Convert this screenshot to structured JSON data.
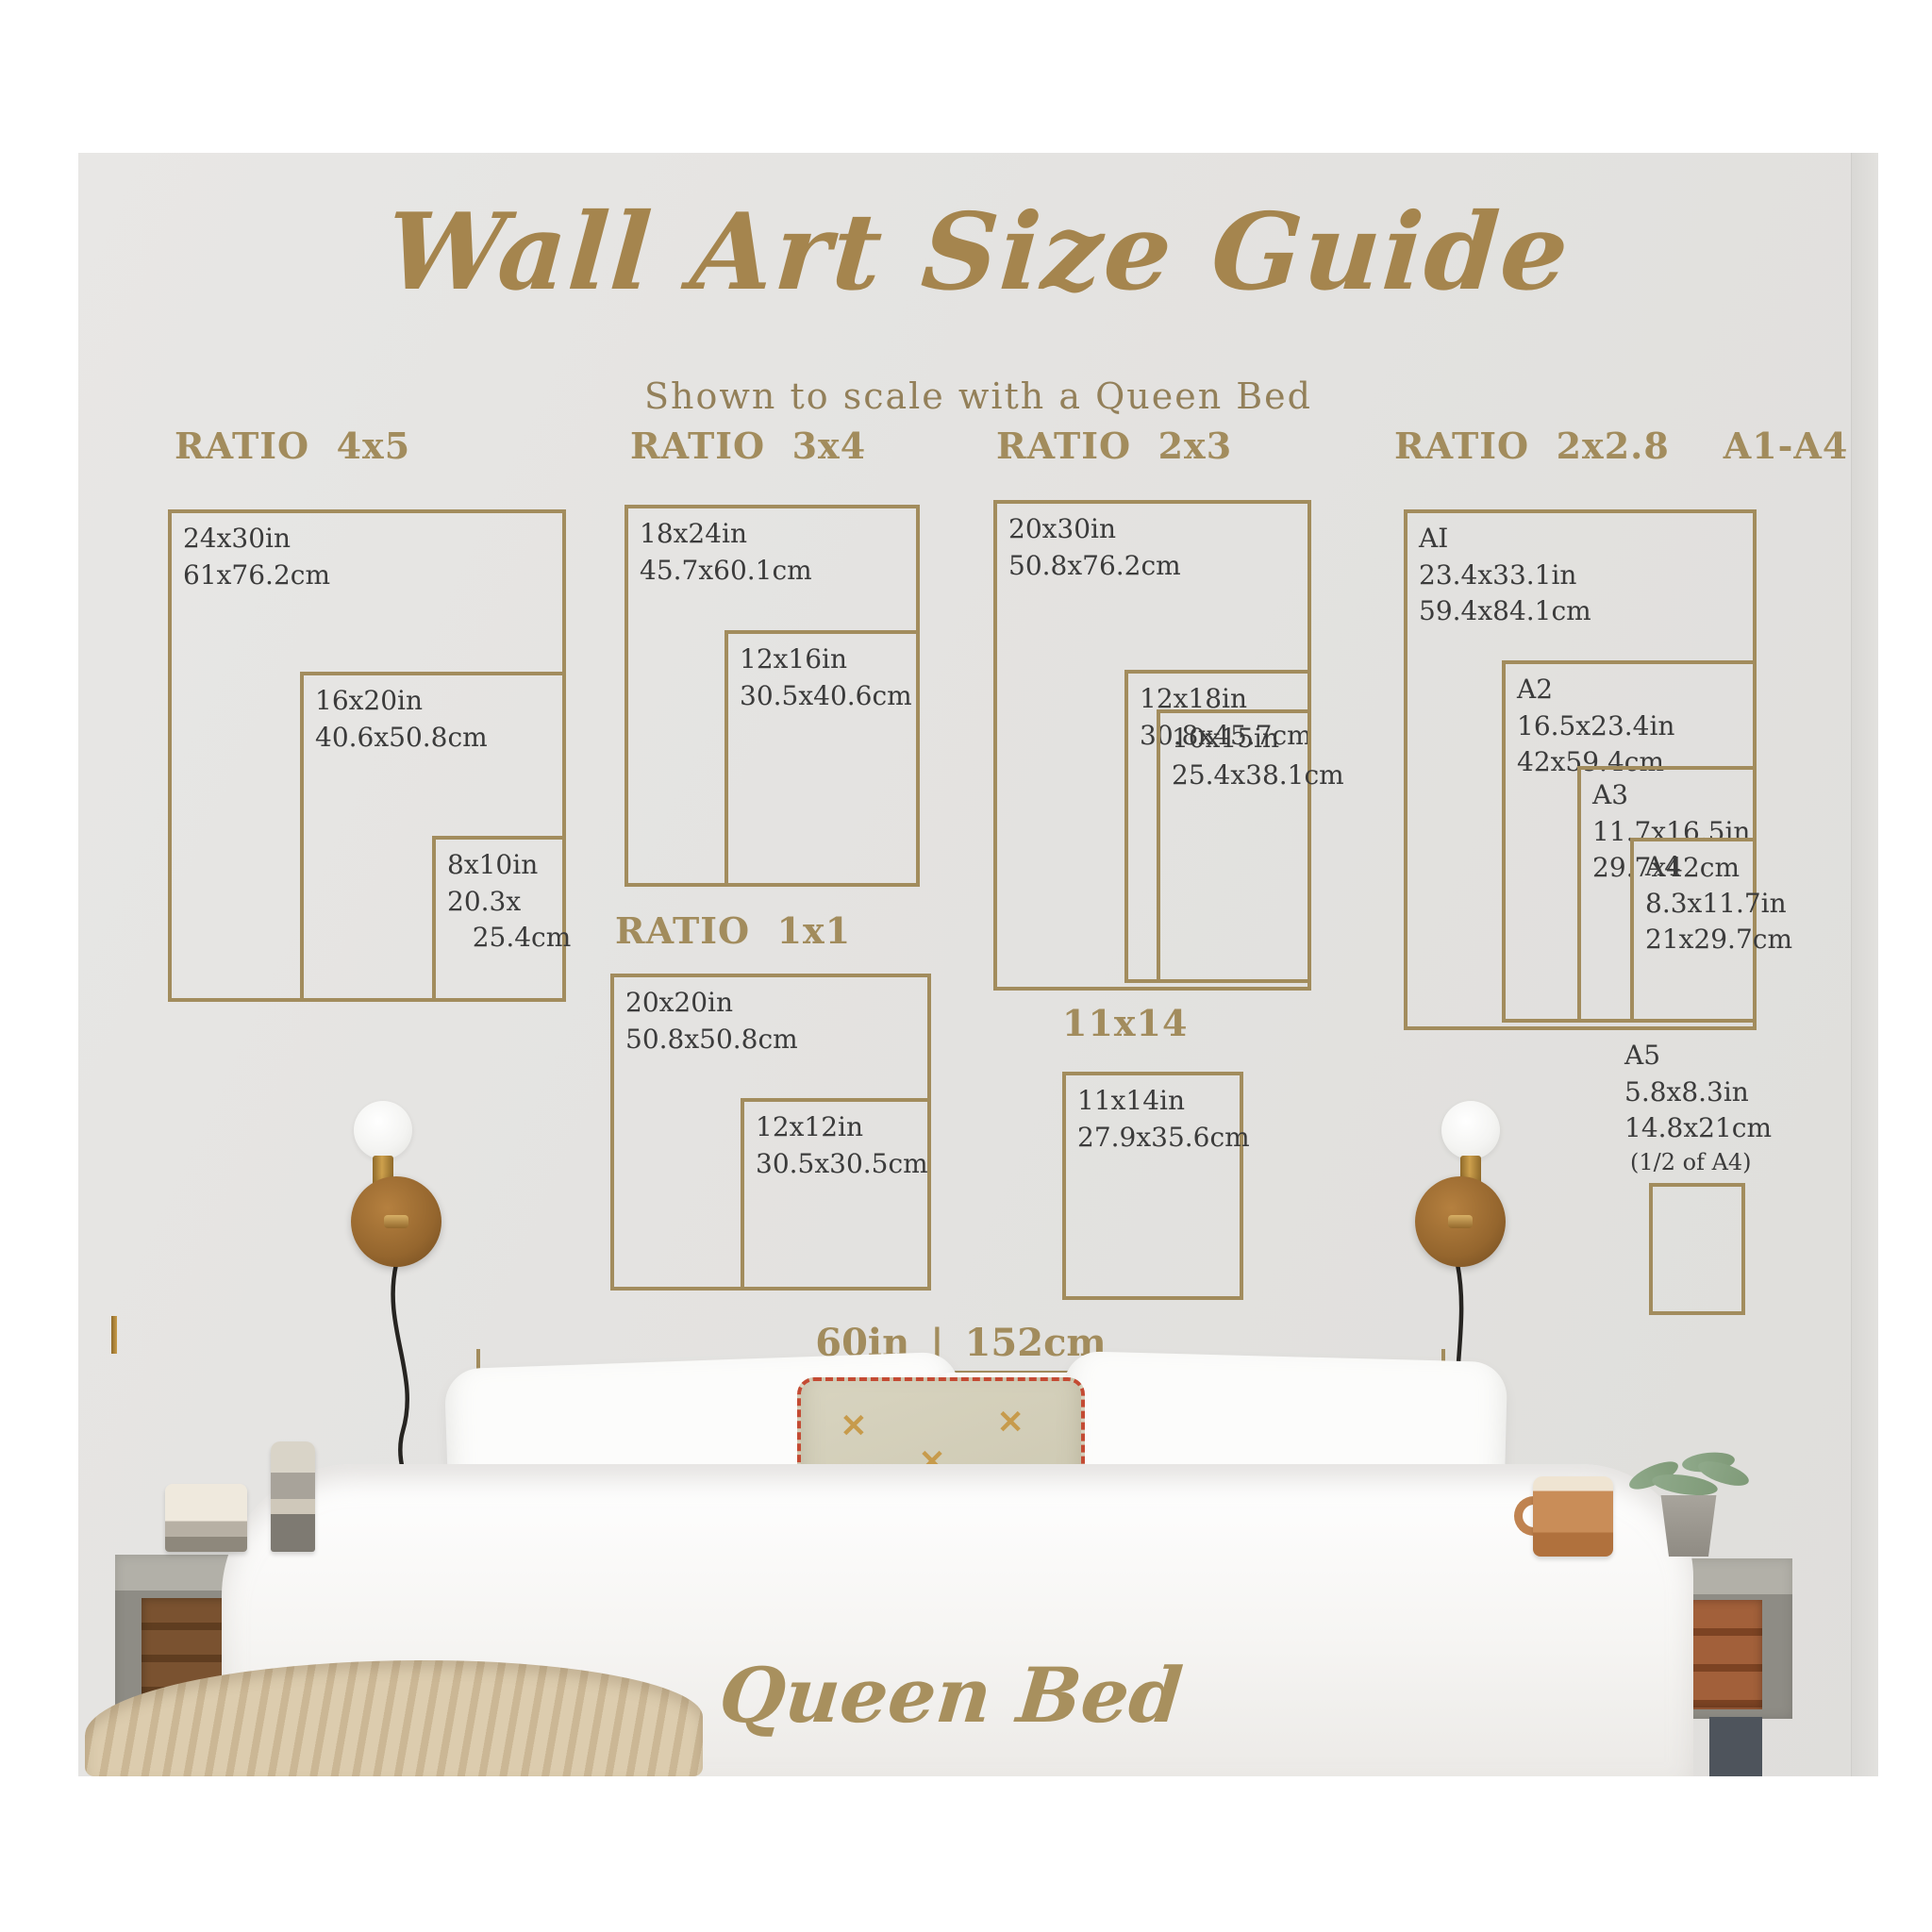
{
  "title": "Wall Art Size Guide",
  "subtitle": "Shown to scale with a Queen Bed",
  "colors": {
    "accent_tan": "#a28c5d",
    "title_gold": "#a5854e",
    "label_ink": "#3b3b3b",
    "wall_gray": "#e4e3e1"
  },
  "groups": [
    {
      "heading": "RATIO  4x5",
      "boxes": [
        {
          "name": "24x30",
          "label": "24x30in\n61x76.2cm"
        },
        {
          "name": "16x20",
          "label": "16x20in\n40.6x50.8cm"
        },
        {
          "name": "8x10",
          "label": "8x10in\n20.3x\n   25.4cm"
        }
      ]
    },
    {
      "heading": "RATIO  3x4",
      "boxes": [
        {
          "name": "18x24",
          "label": "18x24in\n45.7x60.1cm"
        },
        {
          "name": "12x16",
          "label": "12x16in\n30.5x40.6cm"
        }
      ]
    },
    {
      "heading": "RATIO  2x3",
      "boxes": [
        {
          "name": "20x30",
          "label": "20x30in\n50.8x76.2cm"
        },
        {
          "name": "12x18",
          "label": "12x18in\n30.8x45.7cm"
        },
        {
          "name": "10x15",
          "label": "10x15in\n25.4x38.1cm"
        }
      ]
    },
    {
      "heading": "RATIO  2x2.8    A1-A4",
      "boxes": [
        {
          "name": "A1",
          "label": "AI\n23.4x33.1in\n59.4x84.1cm"
        },
        {
          "name": "A2",
          "label": "A2\n16.5x23.4in\n42x59.4cm"
        },
        {
          "name": "A3",
          "label": "A3\n11.7x16.5in\n29.7x42cm"
        },
        {
          "name": "A4",
          "label": "A4\n8.3x11.7in\n21x29.7cm"
        }
      ]
    },
    {
      "heading": "RATIO  1x1",
      "boxes": [
        {
          "name": "20x20",
          "label": "20x20in\n50.8x50.8cm"
        },
        {
          "name": "12x12",
          "label": "12x12in\n30.5x30.5cm"
        }
      ]
    },
    {
      "heading": "11x14",
      "boxes": [
        {
          "name": "11x14",
          "label": "11x14in\n27.9x35.6cm"
        }
      ]
    }
  ],
  "a5": {
    "label": "A5\n5.8x8.3in\n14.8x21cm",
    "note": "(1/2 of A4)"
  },
  "scale_bar": {
    "label": "60in | 152cm"
  },
  "bed_label": "Queen Bed",
  "pillow_motif": "✕"
}
